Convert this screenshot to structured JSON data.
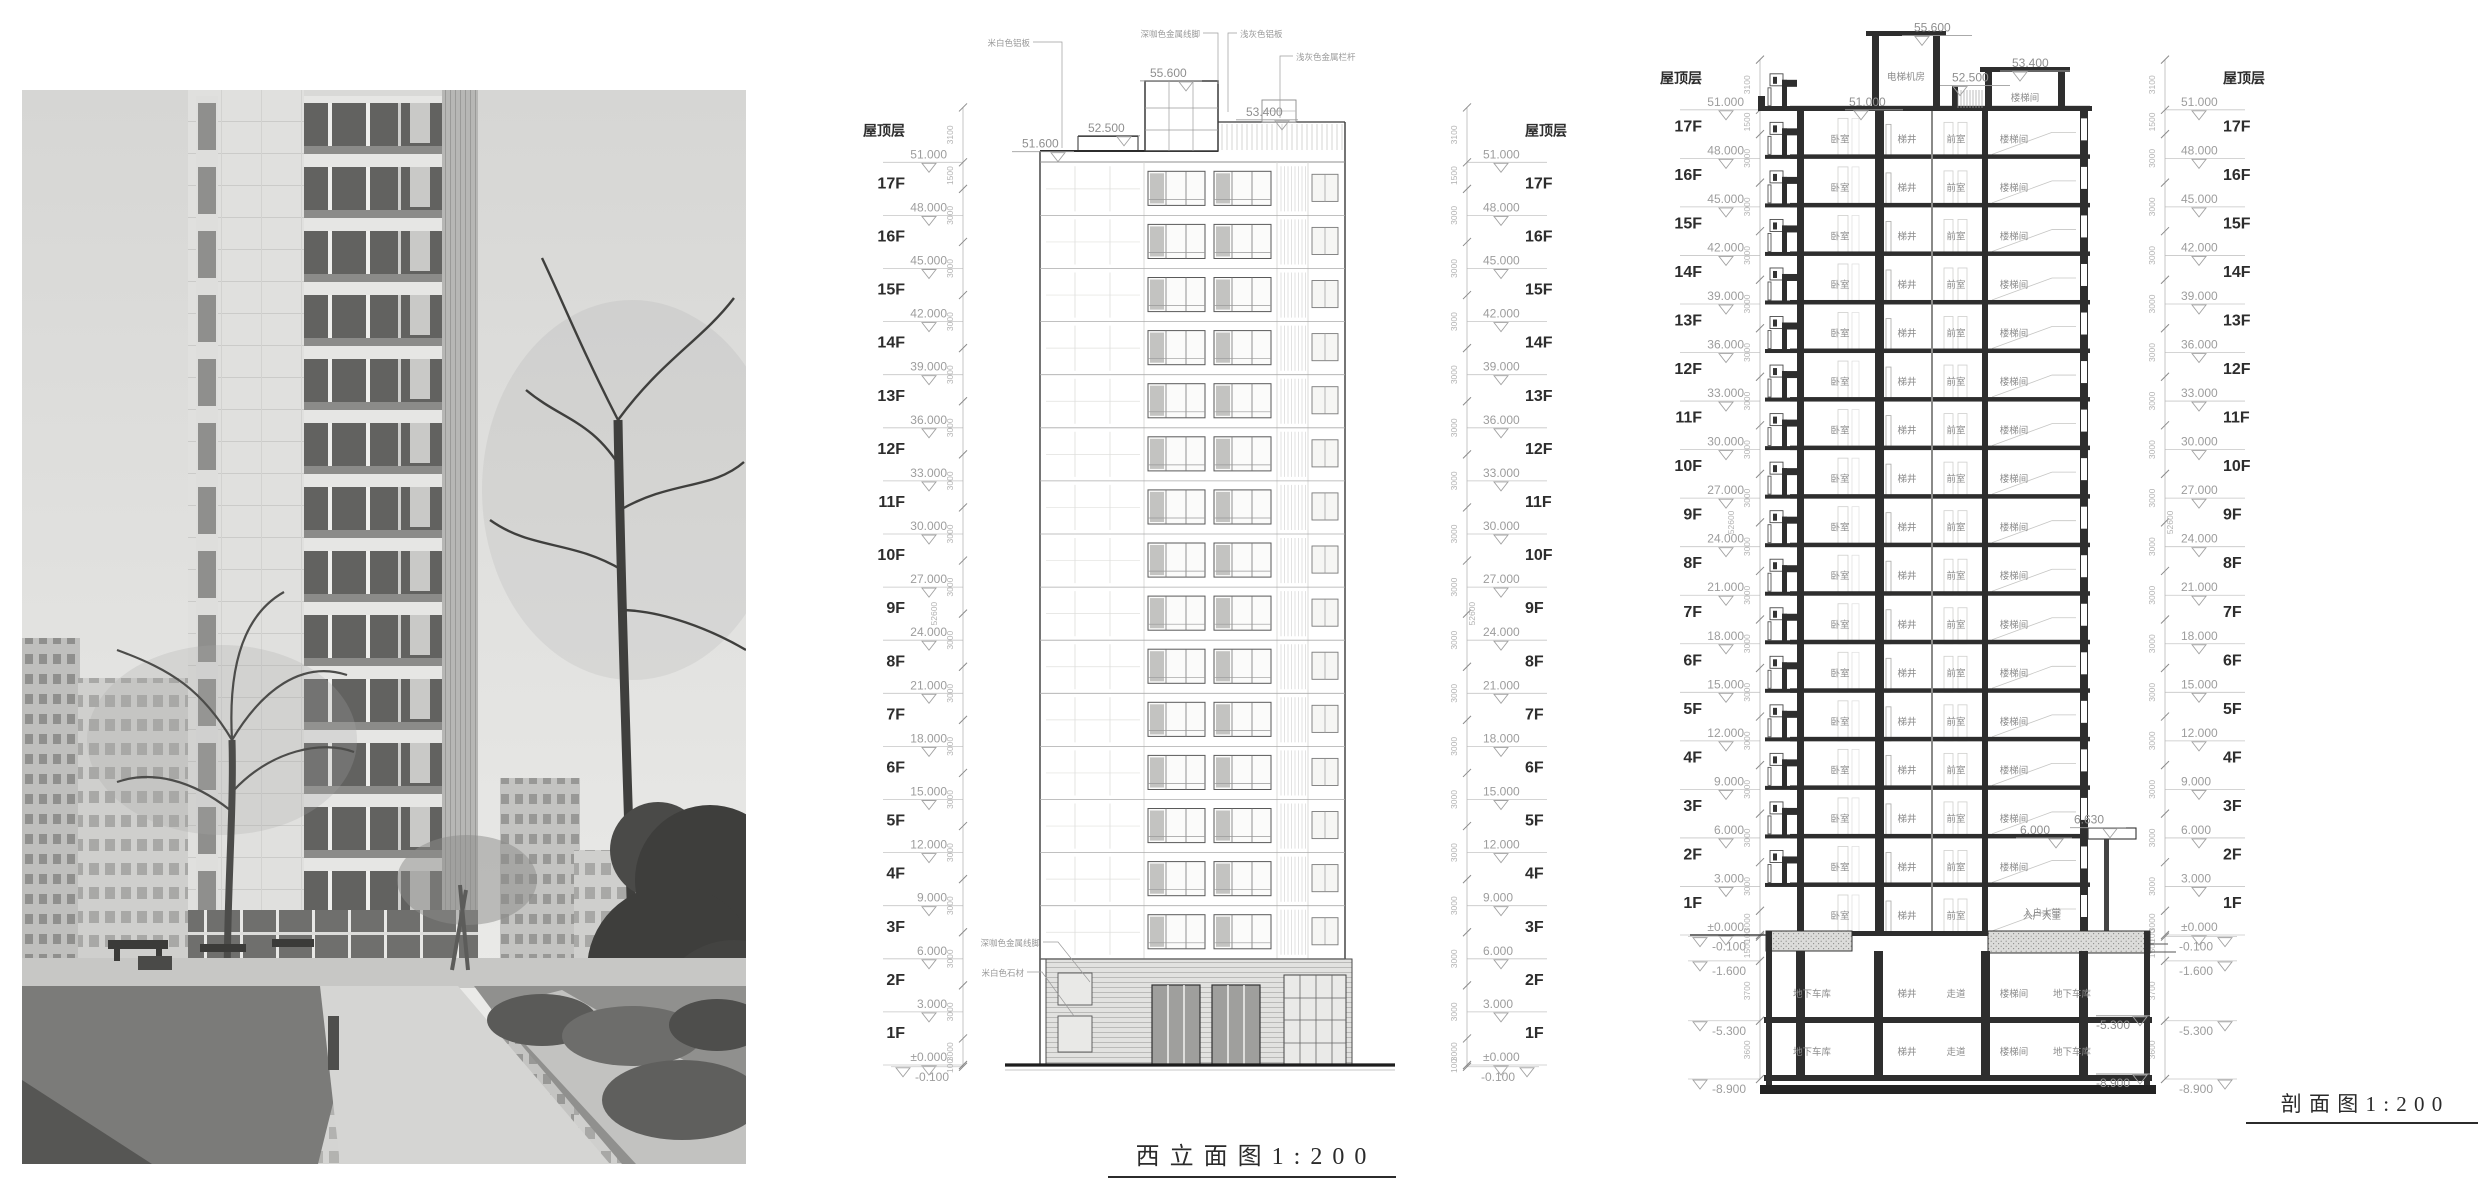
{
  "floors": [
    {
      "name": "屋顶层",
      "level": "51.000"
    },
    {
      "name": "17F",
      "level": "48.000"
    },
    {
      "name": "16F",
      "level": "45.000"
    },
    {
      "name": "15F",
      "level": "42.000"
    },
    {
      "name": "14F",
      "level": "39.000"
    },
    {
      "name": "13F",
      "level": "36.000"
    },
    {
      "name": "12F",
      "level": "33.000"
    },
    {
      "name": "11F",
      "level": "30.000"
    },
    {
      "name": "10F",
      "level": "27.000"
    },
    {
      "name": "9F",
      "level": "24.000"
    },
    {
      "name": "8F",
      "level": "21.000"
    },
    {
      "name": "7F",
      "level": "18.000"
    },
    {
      "name": "6F",
      "level": "15.000"
    },
    {
      "name": "5F",
      "level": "12.000"
    },
    {
      "name": "4F",
      "level": "9.000"
    },
    {
      "name": "3F",
      "level": "6.000"
    },
    {
      "name": "2F",
      "level": "3.000"
    },
    {
      "name": "1F",
      "level": "±0.000"
    }
  ],
  "elevation_view": {
    "title": "西 立 面 图 1 : 2 0 0",
    "below_levels": [
      "-0.100"
    ],
    "top_levels": [
      "51.600",
      "52.500",
      "55.600",
      "53.400"
    ],
    "material_notes_top": [
      "米白色铝板",
      "深咖色金属线脚",
      "浅灰色铝板",
      "浅灰色金属栏杆"
    ],
    "material_notes_base": [
      "深咖色金属线脚",
      "米白色石材"
    ],
    "dims": {
      "above_roof": "3100",
      "roof_band": "1500",
      "typical": "3000",
      "base": "100",
      "overall": "52600"
    }
  },
  "section_view": {
    "title": "剖 面 图 1 : 2 0 0",
    "below_levels": [
      "-0.100",
      "-1.600",
      "-5.300",
      "-8.900"
    ],
    "top_levels": [
      "55.600",
      "52.500",
      "53.400"
    ],
    "interior_top_level": "51.000",
    "roof_rooms": [
      "电梯机房",
      "楼梯间"
    ],
    "typical_rooms": [
      "卧室",
      "梯井",
      "前室",
      "楼梯间"
    ],
    "first_floor_rooms": [
      "卧室",
      "梯井",
      "前室",
      "入户大堂"
    ],
    "basement1_rooms": [
      "地下车库",
      "梯井",
      "走道",
      "楼梯间",
      "地下车库"
    ],
    "basement2_rooms": [
      "地下车库",
      "梯井",
      "走道",
      "楼梯间",
      "地下车库"
    ],
    "basement_levels": [
      "-5.300",
      "-8.900"
    ],
    "canopy_levels": [
      "6.000",
      "6.630"
    ],
    "dims": {
      "above_roof": "3100",
      "roof_band": "1500",
      "typical": "3000",
      "base": "100",
      "below": [
        "1500",
        "3700",
        "3600"
      ],
      "overall": "52600"
    }
  }
}
